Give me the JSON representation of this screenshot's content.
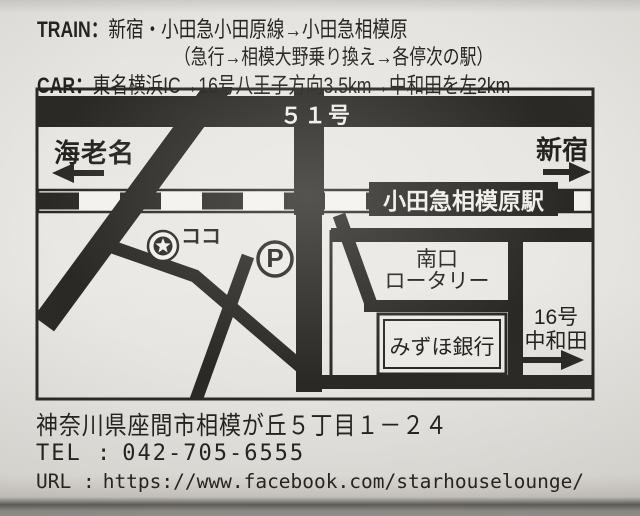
{
  "colors": {
    "ink": "#2b2925",
    "paper": "#eae8e4",
    "photo_edge_gray": "#8f8e89"
  },
  "directions": {
    "train_label": "TRAIN：",
    "train_route": "新宿・小田急小田原線→小田急相模原",
    "train_note": "（急行→相模大野乗り換え→各停次の駅）",
    "car_label": "CAR：",
    "car_route": "東名横浜IC→16号八王子方向3.5km→中和田を左2km"
  },
  "map": {
    "route51_label": "５１号",
    "ebina_label": "海老名",
    "shinjuku_label": "新宿",
    "station_label": "小田急相模原駅",
    "here_label": "ココ",
    "parking_label": "P",
    "rotary_label_line1": "南口",
    "rotary_label_line2": "ロータリー",
    "bank_label": "みずほ銀行",
    "route16_label_line1": "16号",
    "route16_label_line2": "中和田"
  },
  "contact": {
    "address": "神奈川県座間市相模が丘５丁目１－２４",
    "tel_label": "TEL :",
    "tel": "042-705-6555",
    "url_label": "URL :",
    "url": "https://www.facebook.com/starhouselounge/"
  }
}
